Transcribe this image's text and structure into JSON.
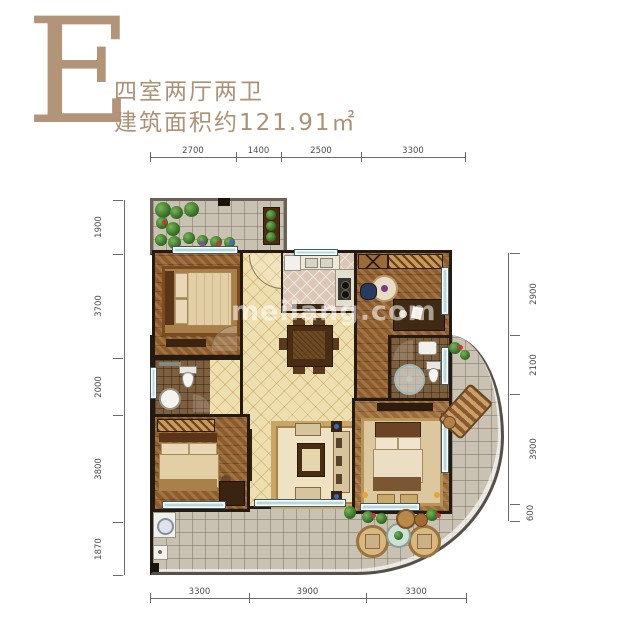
{
  "header": {
    "letter": "E",
    "layout": "四室两厅两卫",
    "area": "建筑面积约121.91㎡"
  },
  "watermark": "meilang.com",
  "dimensions": {
    "top": [
      "2700",
      "1400",
      "2500",
      "3300"
    ],
    "left": [
      "1900",
      "3700",
      "2000",
      "3800",
      "1870"
    ],
    "right": [
      "2900",
      "2100",
      "3900",
      "600"
    ],
    "bottom": [
      "3300",
      "3900",
      "3300"
    ]
  },
  "colors": {
    "accent_tan": "#b29579",
    "wall": "#241a10",
    "cream_tile": "#eedfb0",
    "wood_floor": "#8d5c2e",
    "terrace_tile": "#c9c2b2",
    "window_glass": "#b6d8da",
    "dimension_line": "#6a6a6a"
  }
}
